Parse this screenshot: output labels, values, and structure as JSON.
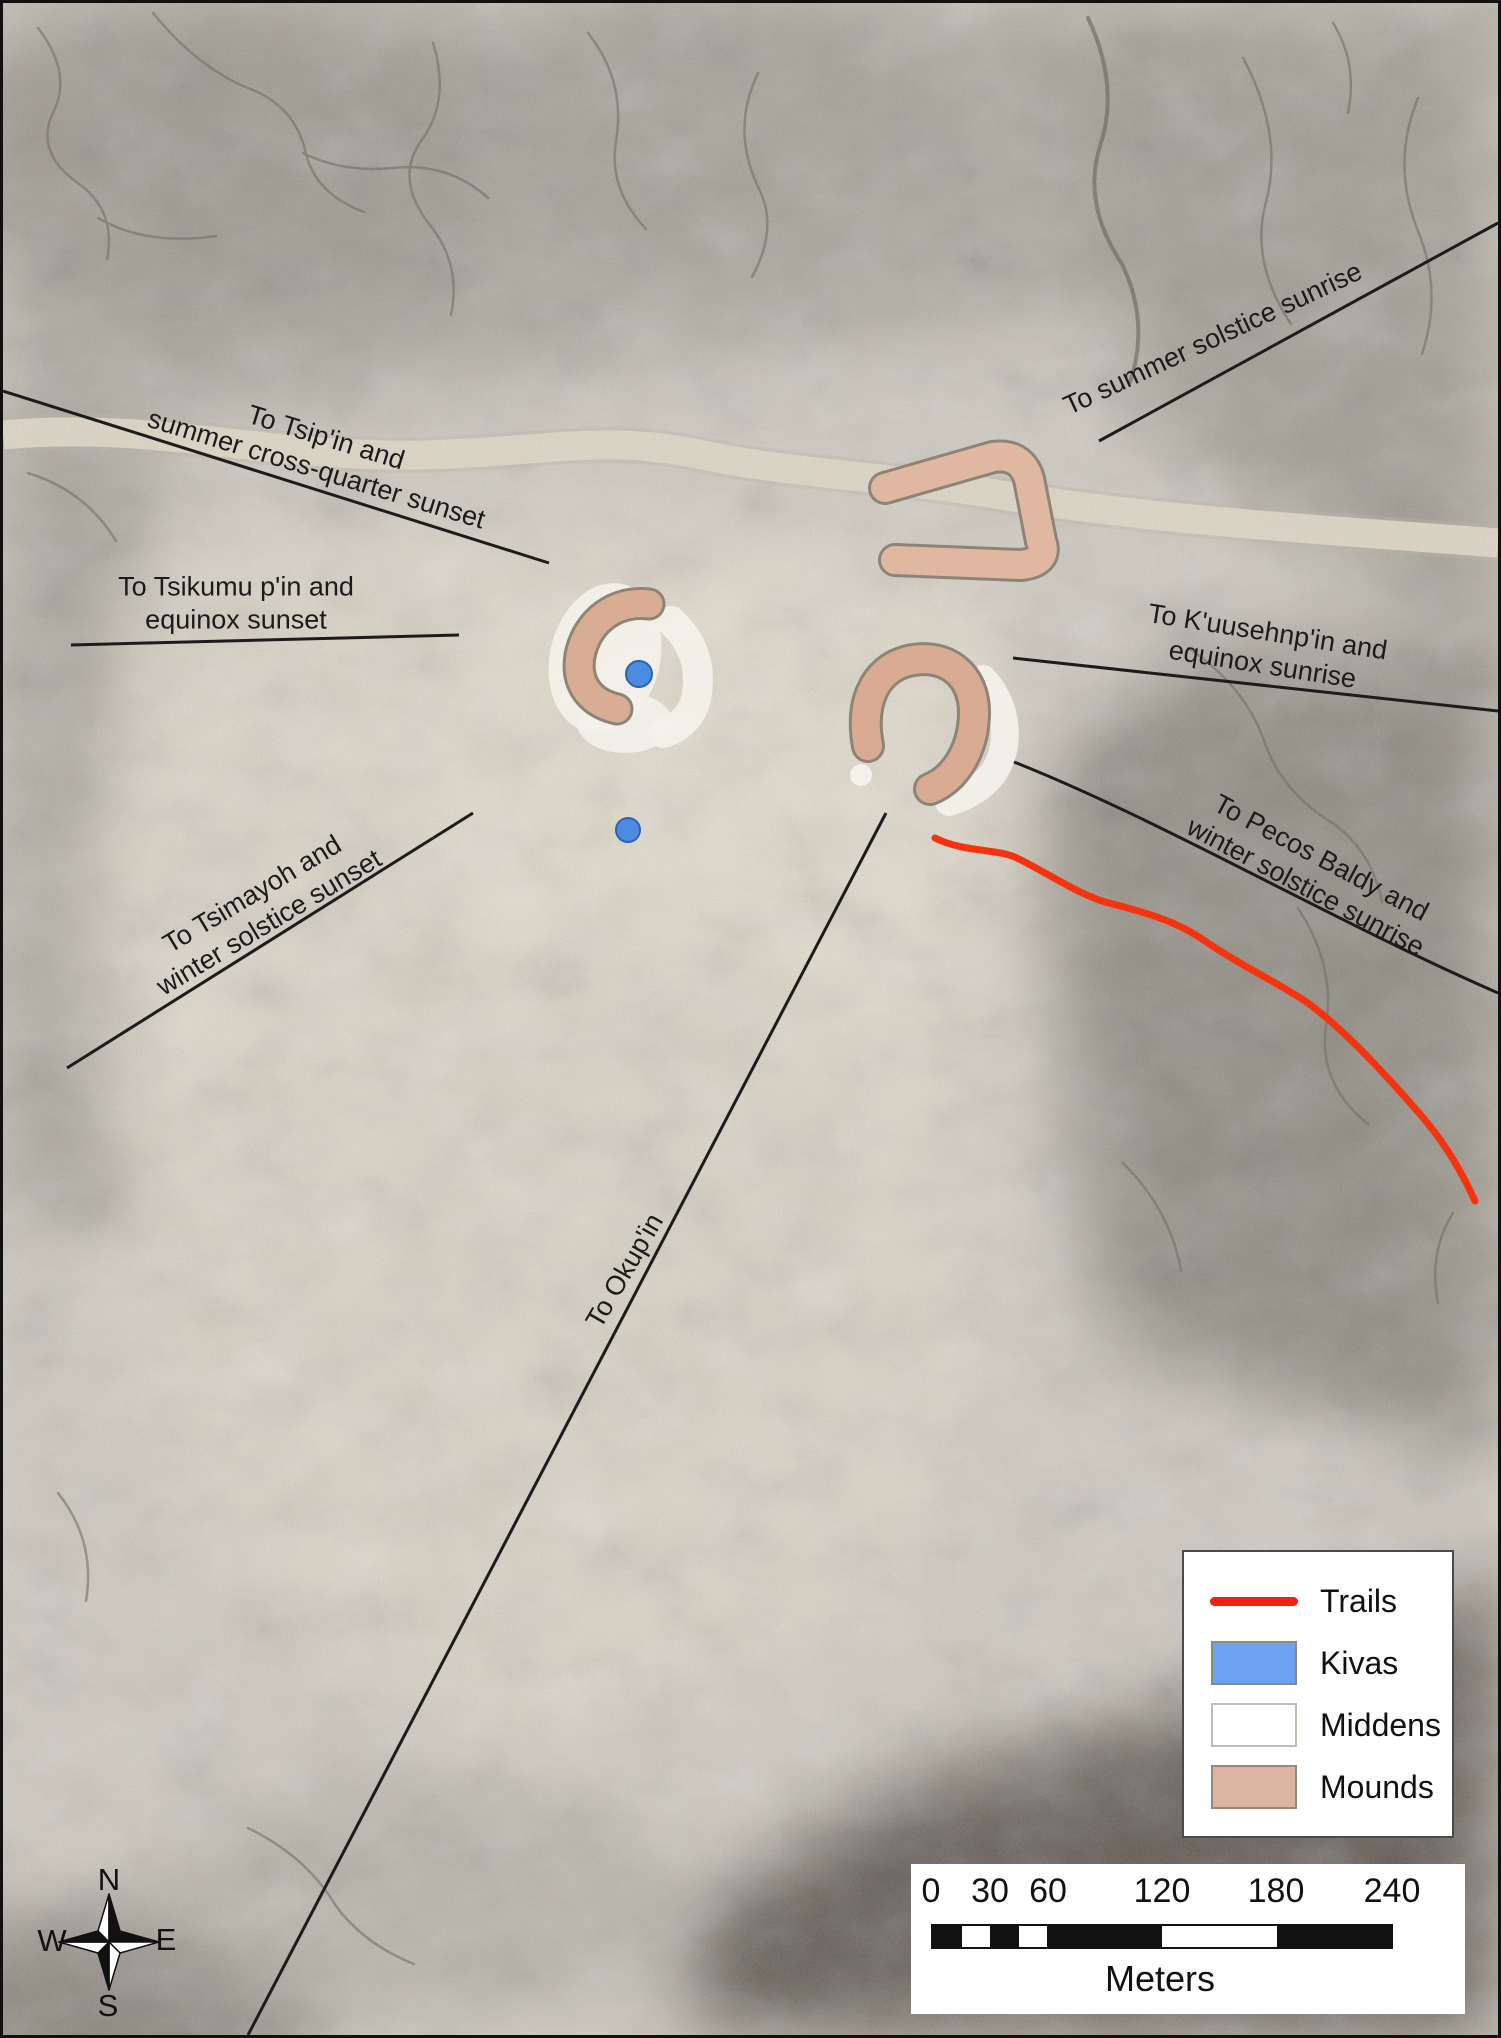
{
  "sight_lines": [
    {
      "name": "tsipin",
      "line1": "To Tsip'in and",
      "line2": "summer cross-quarter sunset"
    },
    {
      "name": "tsikumu",
      "line1": "To Tsikumu p'in and",
      "line2": "equinox sunset"
    },
    {
      "name": "summer_solstice",
      "line1": "To summer solstice sunrise"
    },
    {
      "name": "kuusehnpin",
      "line1": "To K'uusehnp'in and",
      "line2": "equinox sunrise"
    },
    {
      "name": "tsimayoh",
      "line1": "To Tsimayoh and",
      "line2": "winter solstice sunset"
    },
    {
      "name": "pecos_baldy",
      "line1": "To Pecos Baldy and",
      "line2": "winter solstice sunrise"
    },
    {
      "name": "okupin",
      "line1": "To Okup'in"
    }
  ],
  "legend": {
    "items": [
      {
        "label": "Trails",
        "swatch": "red-line",
        "color": "#ee2211"
      },
      {
        "label": "Kivas",
        "swatch": "filled-rect",
        "color": "#6ba3f2"
      },
      {
        "label": "Middens",
        "swatch": "filled-rect",
        "color": "#ffffff"
      },
      {
        "label": "Mounds",
        "swatch": "filled-rect",
        "color": "#dcb5a2"
      }
    ]
  },
  "scalebar": {
    "ticks": [
      "0",
      "30",
      "60",
      "120",
      "180",
      "240"
    ],
    "unit": "Meters"
  },
  "compass": {
    "n": "N",
    "e": "E",
    "s": "S",
    "w": "W"
  },
  "map_colors": {
    "trail": "#f5330f",
    "kiva_fill": "#4a8ce2",
    "midden_fill": "#f3f1ea",
    "mound_fill": "#d9ad94",
    "mound_outline": "#8d8478",
    "sight_line": "#1c1c1c",
    "road": "#ddd6c6"
  }
}
